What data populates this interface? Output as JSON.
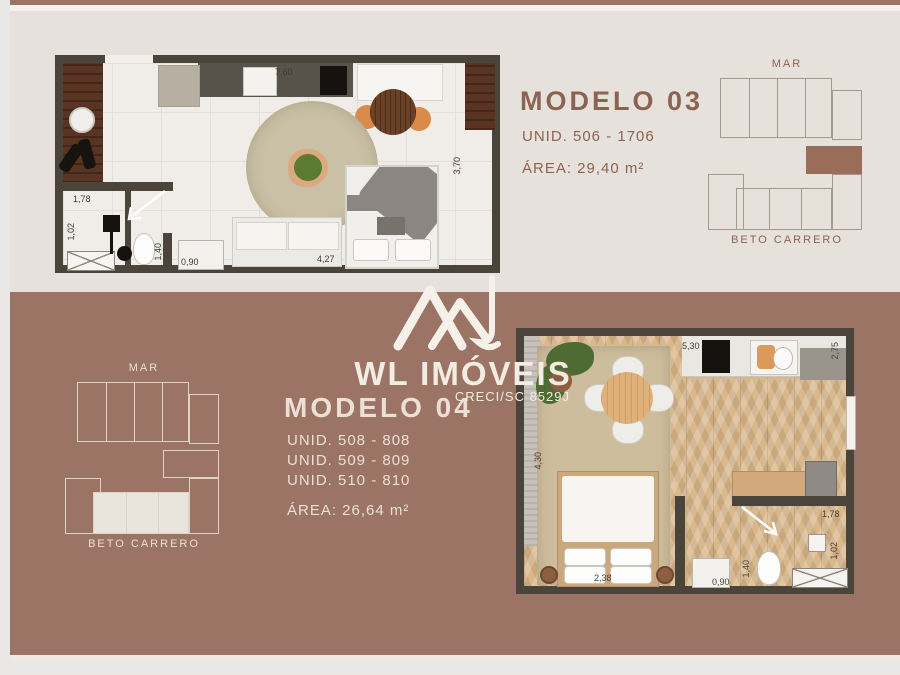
{
  "brand": {
    "name": "WL IMÓVEIS",
    "creci": "CRECI/SC 8529J"
  },
  "colors": {
    "cream_bg": "#e6e2db",
    "brown_bg": "#9b7466",
    "title_brown": "#8c6353",
    "title_cream": "#ecdfd3",
    "wall": "#4b443b",
    "map_highlight": "#9a6d5a"
  },
  "model03": {
    "title": "MODELO 03",
    "units": "UNID. 506 - 1706",
    "area": "ÁREA: 29,40 m²",
    "dims": {
      "d760": "7,60",
      "d370": "3,70",
      "d427": "4,27",
      "d178": "1,78",
      "d102": "1,02",
      "d140": "1,40",
      "d090": "0,90"
    },
    "sitemap": {
      "top": "MAR",
      "bottom": "BETO CARRERO"
    }
  },
  "model04": {
    "title": "MODELO 04",
    "units": [
      "UNID. 508 - 808",
      "UNID. 509 - 809",
      "UNID. 510 - 810"
    ],
    "area": "ÁREA: 26,64 m²",
    "dims": {
      "d530": "5,30",
      "d275": "2,75",
      "d430": "4,30",
      "d238": "2,38",
      "d178": "1,78",
      "d102": "1,02",
      "d140": "1,40",
      "d090": "0,90"
    },
    "sitemap": {
      "top": "MAR",
      "bottom": "BETO CARRERO"
    }
  }
}
